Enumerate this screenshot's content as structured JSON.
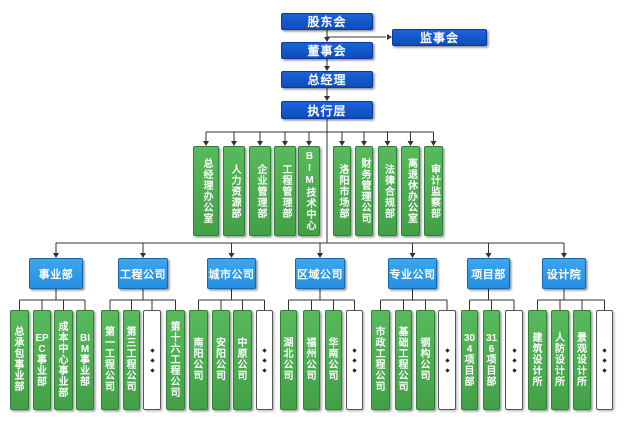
{
  "colors": {
    "top_box_blue": "#1254c4",
    "division_box_blue": "#2f9ce9",
    "department_box_green": "#4caf50",
    "connector_line": "#333333",
    "placeholder_box_white": "#ffffff"
  },
  "org": {
    "top": [
      {
        "label": "股东会"
      },
      {
        "label": "监事会"
      },
      {
        "label": "董事会"
      },
      {
        "label": "总经理"
      },
      {
        "label": "执行层"
      }
    ],
    "departments": [
      "总经理办公室",
      "人力资源部",
      "企业管理部",
      "工程管理部",
      "BIM技术中心",
      "洛阳市场部",
      "财务管理公司",
      "法律合规部",
      "离退休办公室",
      "审计监察部"
    ],
    "divisions": [
      {
        "label": "事业部",
        "children": [
          {
            "label": "总承包事业部"
          },
          {
            "label": "EPC事业部"
          },
          {
            "label": "成本中心事业部"
          },
          {
            "label": "BIM事业部"
          }
        ]
      },
      {
        "label": "工程公司",
        "children": [
          {
            "label": "第一工程公司"
          },
          {
            "label": "第三工程公司"
          },
          {
            "ellipsis": true
          },
          {
            "label": "第十六工程公司"
          }
        ]
      },
      {
        "label": "城市公司",
        "children": [
          {
            "label": "南阳公司"
          },
          {
            "label": "安阳公司"
          },
          {
            "label": "中原公司"
          },
          {
            "ellipsis": true
          }
        ]
      },
      {
        "label": "区域公司",
        "children": [
          {
            "label": "湖北公司"
          },
          {
            "label": "福州公司"
          },
          {
            "label": "华南公司"
          },
          {
            "ellipsis": true
          }
        ]
      },
      {
        "label": "专业公司",
        "children": [
          {
            "label": "市政工程公司"
          },
          {
            "label": "基础工程公司"
          },
          {
            "label": "钢构公司"
          },
          {
            "ellipsis": true
          }
        ]
      },
      {
        "label": "项目部",
        "children": [
          {
            "label": "304项目部"
          },
          {
            "label": "316项目部"
          },
          {
            "ellipsis": true
          }
        ]
      },
      {
        "label": "设计院",
        "children": [
          {
            "label": "建筑设计所"
          },
          {
            "label": "人防设计所"
          },
          {
            "label": "景观设计所"
          },
          {
            "ellipsis": true
          }
        ]
      }
    ]
  }
}
